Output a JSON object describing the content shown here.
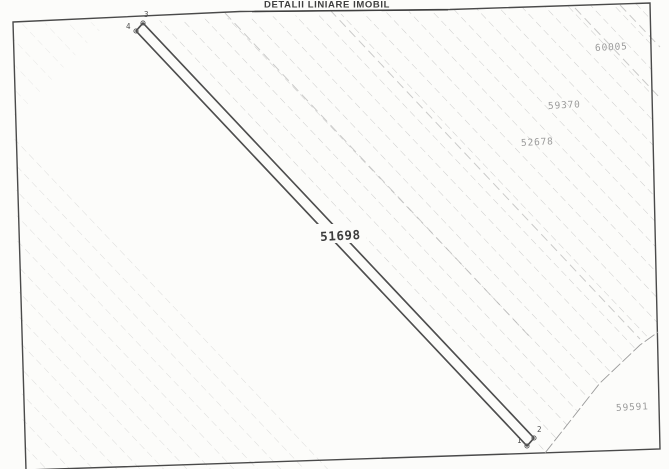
{
  "document": {
    "title": "DETALII LINIARE IMOBIL"
  },
  "map": {
    "main_parcel": {
      "number": "51698",
      "shape": "long narrow strip, upper-left to lower-right"
    },
    "neighbor_parcels": [
      {
        "number": "60005",
        "position": "top-right"
      },
      {
        "number": "59370",
        "position": "upper-right"
      },
      {
        "number": "52678",
        "position": "upper-right"
      },
      {
        "number": "59591",
        "position": "bottom-right"
      }
    ],
    "boundary_points": [
      {
        "label": "1",
        "position": "strip bottom end, left corner"
      },
      {
        "label": "2",
        "position": "strip bottom end, right corner"
      },
      {
        "label": "3",
        "position": "strip top end, right corner"
      },
      {
        "label": "4",
        "position": "strip top end, left corner"
      }
    ]
  },
  "colors": {
    "paper": "#fcfcfa",
    "frame_line": "#4a4a4a",
    "strip_line": "#4f4f4f",
    "hatch_line": "#a9a9a9",
    "boundary_line": "#9b9b9b",
    "neighbor_label": "#9b9b9b",
    "main_label": "#3d3d3d"
  }
}
